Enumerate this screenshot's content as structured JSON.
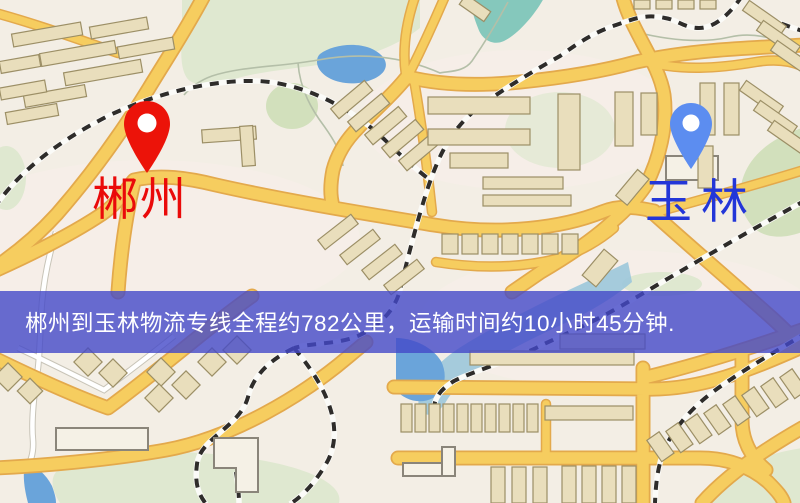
{
  "map": {
    "origin": {
      "label": "郴州"
    },
    "destination": {
      "label": "玉林"
    }
  },
  "banner": {
    "text": "郴州到玉林物流专线全程约782公里，运输时间约10小时45分钟."
  },
  "colors": {
    "origin_pin": "#ec1309",
    "origin_label": "#ea0a0a",
    "destination_pin": "#5c8df0",
    "destination_label": "#2336d8",
    "banner_bg": "rgba(67,72,200,0.8)",
    "banner_text": "#ffffff",
    "road": "#f6cd5f",
    "road_casing": "#e3a94c",
    "water": "#6aa4da",
    "park": "#dfe8d0",
    "building": "#e9debc",
    "rail": "#2e2c2a",
    "map_bg": "#f3eee5"
  }
}
